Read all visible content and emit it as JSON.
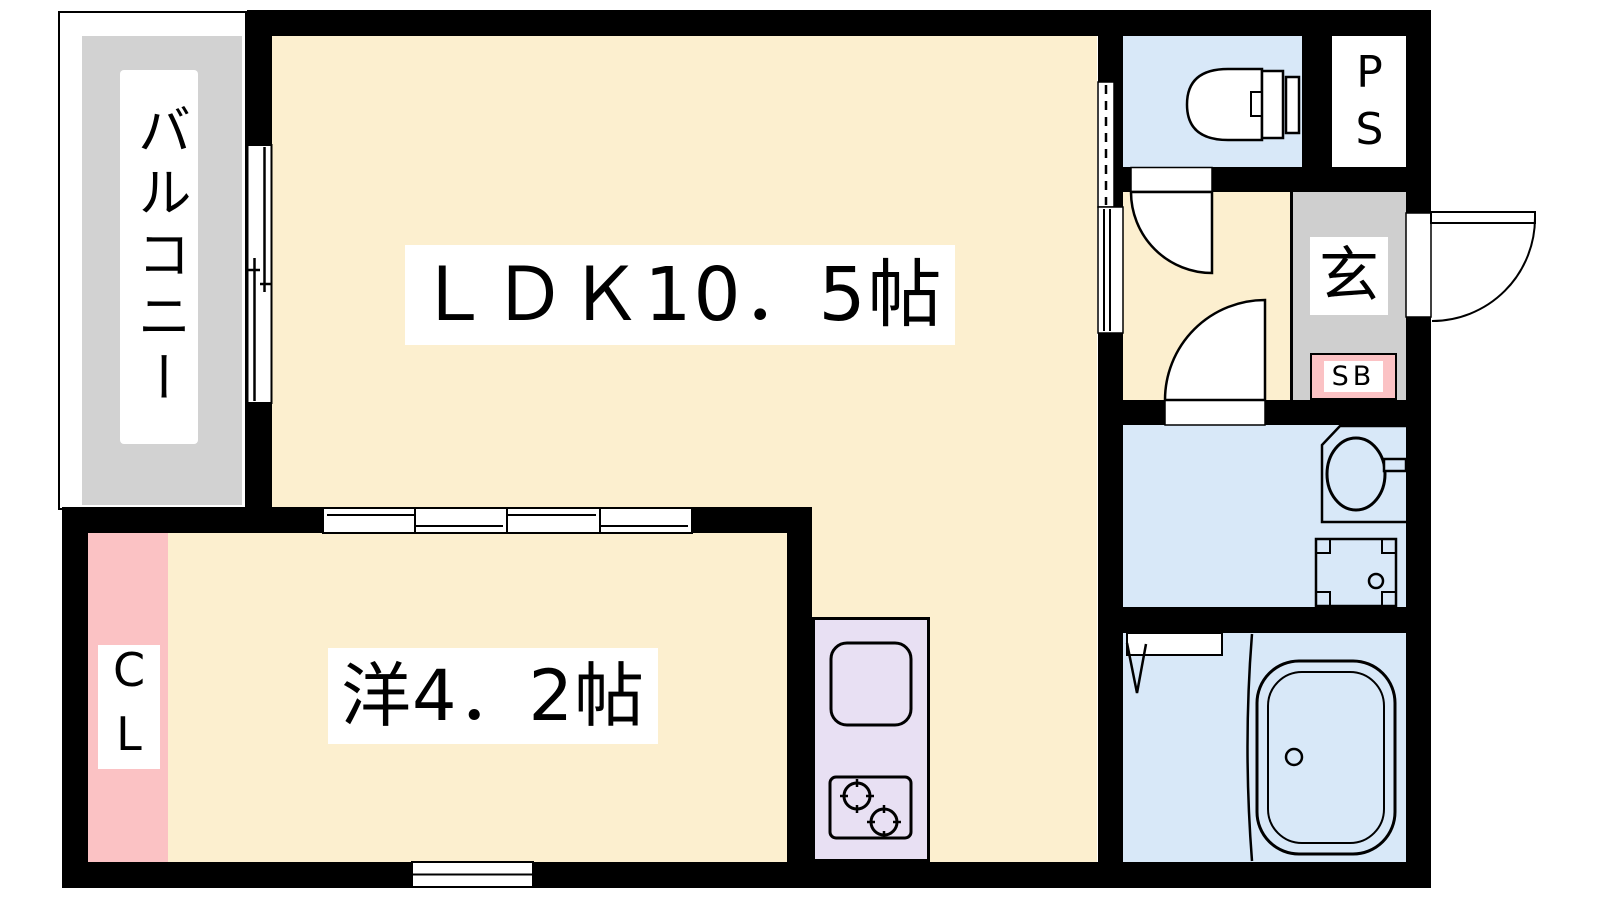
{
  "plan": {
    "type": "apartment-floor-plan",
    "labels": {
      "balcony": "バルコニー",
      "ldk": "ＬＤＫ10．5帖",
      "western_room": "洋4．2帖",
      "closet": "CL",
      "entrance": "玄",
      "shoe_box": "SB",
      "pipe_space": "PS"
    },
    "colors": {
      "room_floor": "#FCEFCF",
      "wet_area": "#D8E8F8",
      "kitchen_unit": "#E8E0F3",
      "closet_pink": "#FBC2C4",
      "balcony_gray": "#D2D2D2",
      "entrance_gray": "#CFCFCF",
      "wall": "#000000",
      "background": "#FFFFFF"
    }
  }
}
